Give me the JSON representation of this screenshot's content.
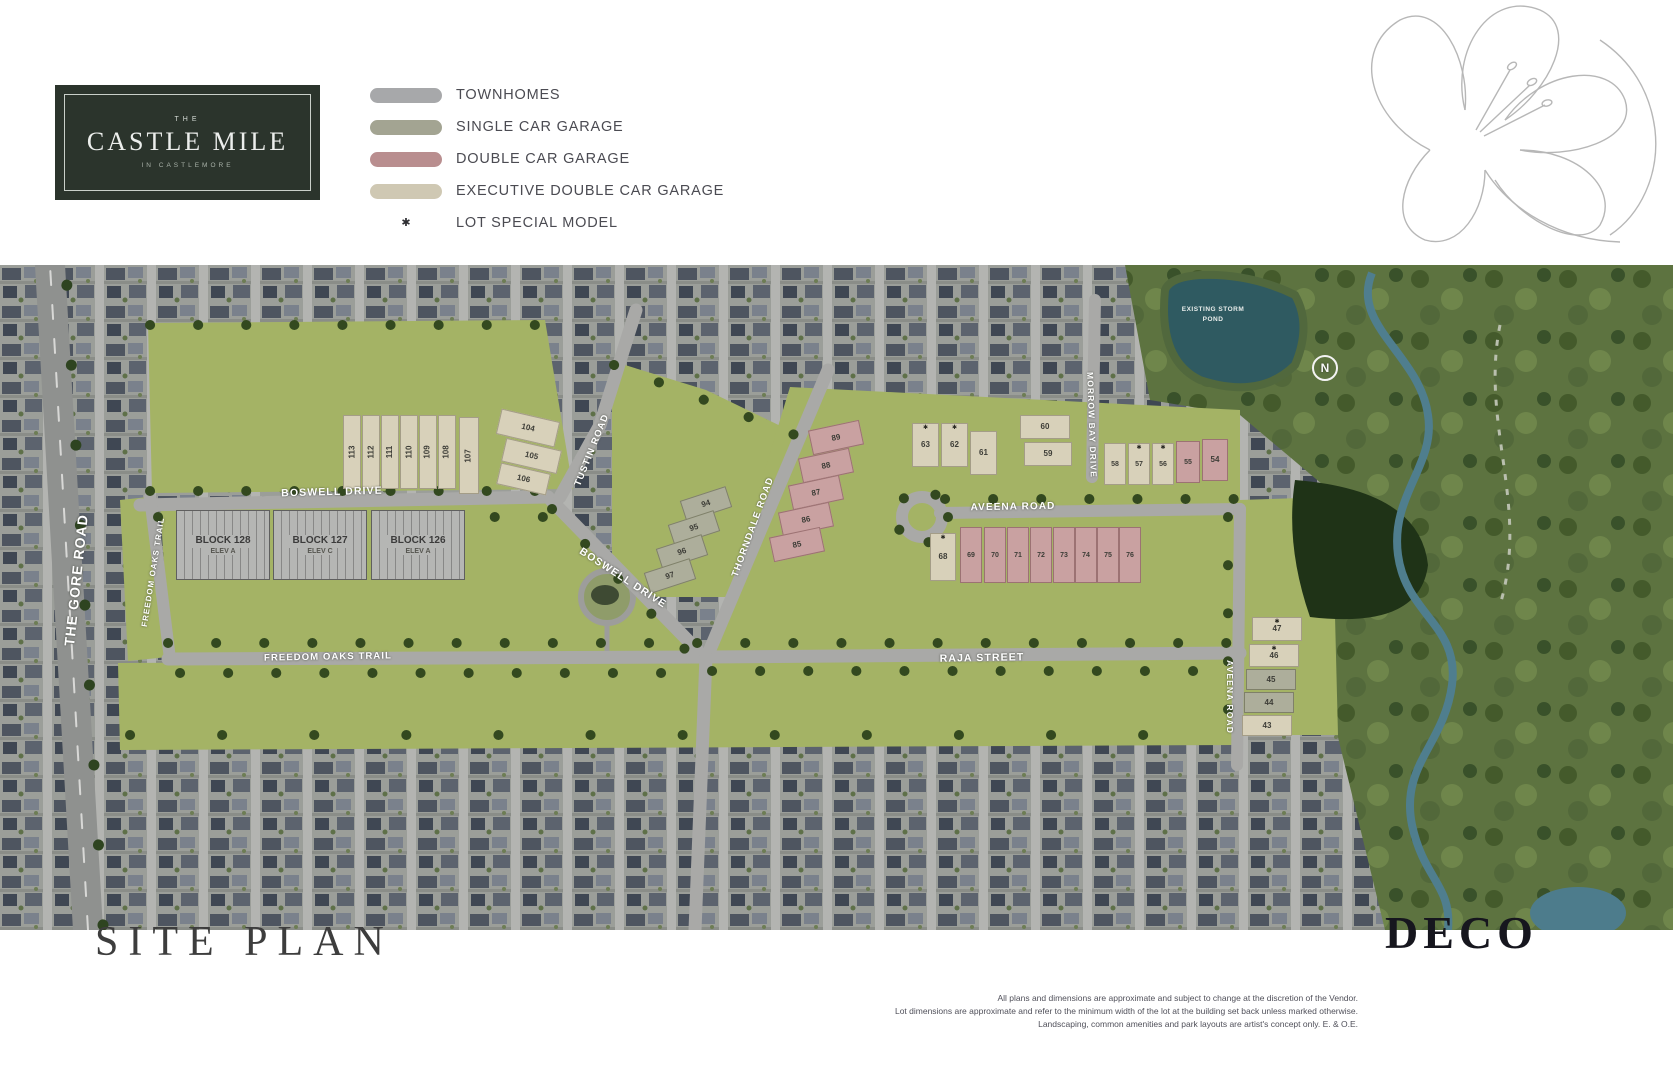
{
  "header": {
    "logo": {
      "top": "THE",
      "main": "CASTLE MILE",
      "sub": "IN CASTLEMORE"
    },
    "legend": [
      {
        "label": "TOWNHOMES",
        "type": "swatch",
        "color": "#a7a8aa"
      },
      {
        "label": "SINGLE CAR GARAGE",
        "type": "swatch",
        "color": "#a3a492"
      },
      {
        "label": "DOUBLE CAR GARAGE",
        "type": "swatch",
        "color": "#b98e8f"
      },
      {
        "label": "EXECUTIVE DOUBLE CAR GARAGE",
        "type": "swatch",
        "color": "#cfc8b3"
      },
      {
        "label": "LOT SPECIAL MODEL",
        "type": "star",
        "icon": "✱"
      }
    ]
  },
  "map": {
    "compass_label": "N",
    "pond_label": "EXISTING STORM POND",
    "road_labels": [
      {
        "text": "THE GORE ROAD",
        "x": 76,
        "y": 315,
        "rot": -84,
        "size": 14
      },
      {
        "text": "FREEDOM OAKS TRAIL",
        "x": 153,
        "y": 307,
        "rot": -81,
        "size": 8
      },
      {
        "text": "BOSWELL DRIVE",
        "x": 332,
        "y": 227,
        "rot": -1.5,
        "size": 10.5
      },
      {
        "text": "TUSTIN ROAD",
        "x": 592,
        "y": 185,
        "rot": -68,
        "size": 9.5
      },
      {
        "text": "BOSWELL DRIVE",
        "x": 623,
        "y": 313,
        "rot": 33,
        "size": 10.5
      },
      {
        "text": "THORNDALE ROAD",
        "x": 753,
        "y": 262,
        "rot": -70,
        "size": 9.5
      },
      {
        "text": "FREEDOM OAKS TRAIL",
        "x": 328,
        "y": 392,
        "rot": -1,
        "size": 9.5
      },
      {
        "text": "AVEENA ROAD",
        "x": 1013,
        "y": 242,
        "rot": -1,
        "size": 10
      },
      {
        "text": "RAJA STREET",
        "x": 982,
        "y": 393,
        "rot": -1,
        "size": 10.5
      },
      {
        "text": "MORROW BAY DRIVE",
        "x": 1092,
        "y": 160,
        "rot": 88,
        "size": 8.5
      },
      {
        "text": "AVEENA ROAD",
        "x": 1230,
        "y": 432,
        "rot": 90,
        "size": 8.5
      }
    ],
    "blocks": [
      {
        "name": "BLOCK 128",
        "elev": "ELEV A",
        "x": 176,
        "y": 245
      },
      {
        "name": "BLOCK 127",
        "elev": "ELEV C",
        "x": 273,
        "y": 245
      },
      {
        "name": "BLOCK 126",
        "elev": "ELEV A",
        "x": 371,
        "y": 245
      }
    ],
    "lots": [
      {
        "n": "113",
        "t": "exec",
        "x": 343,
        "y": 150,
        "w": 18,
        "h": 74,
        "nr": -90
      },
      {
        "n": "112",
        "t": "exec",
        "x": 362,
        "y": 150,
        "w": 18,
        "h": 74,
        "nr": -90
      },
      {
        "n": "111",
        "t": "exec",
        "x": 381,
        "y": 150,
        "w": 18,
        "h": 74,
        "nr": -90
      },
      {
        "n": "110",
        "t": "exec",
        "x": 400,
        "y": 150,
        "w": 18,
        "h": 74,
        "nr": -90
      },
      {
        "n": "109",
        "t": "exec",
        "x": 419,
        "y": 150,
        "w": 18,
        "h": 74,
        "nr": -90
      },
      {
        "n": "108",
        "t": "exec",
        "x": 438,
        "y": 150,
        "w": 18,
        "h": 74,
        "nr": -90
      },
      {
        "n": "107",
        "t": "exec",
        "x": 459,
        "y": 152,
        "w": 20,
        "h": 77,
        "nr": -90
      },
      {
        "n": "104",
        "t": "exec",
        "x": 498,
        "y": 150,
        "w": 60,
        "h": 26,
        "r": 13
      },
      {
        "n": "105",
        "t": "exec",
        "x": 503,
        "y": 179,
        "w": 57,
        "h": 24,
        "r": 13
      },
      {
        "n": "106",
        "t": "exec",
        "x": 498,
        "y": 203,
        "w": 51,
        "h": 22,
        "r": 13
      },
      {
        "n": "94",
        "t": "single",
        "x": 682,
        "y": 228,
        "w": 48,
        "h": 22,
        "r": -18
      },
      {
        "n": "95",
        "t": "single",
        "x": 670,
        "y": 252,
        "w": 48,
        "h": 22,
        "r": -18
      },
      {
        "n": "96",
        "t": "single",
        "x": 658,
        "y": 276,
        "w": 48,
        "h": 22,
        "r": -18
      },
      {
        "n": "97",
        "t": "single",
        "x": 646,
        "y": 300,
        "w": 48,
        "h": 22,
        "r": -18
      },
      {
        "n": "89",
        "t": "double",
        "x": 810,
        "y": 160,
        "w": 52,
        "h": 25,
        "r": -12
      },
      {
        "n": "88",
        "t": "double",
        "x": 800,
        "y": 188,
        "w": 52,
        "h": 25,
        "r": -12
      },
      {
        "n": "87",
        "t": "double",
        "x": 790,
        "y": 215,
        "w": 52,
        "h": 25,
        "r": -12
      },
      {
        "n": "86",
        "t": "double",
        "x": 780,
        "y": 242,
        "w": 52,
        "h": 25,
        "r": -12
      },
      {
        "n": "85",
        "t": "double",
        "x": 771,
        "y": 267,
        "w": 52,
        "h": 25,
        "r": -12
      },
      {
        "n": "63",
        "t": "exec",
        "x": 912,
        "y": 158,
        "w": 27,
        "h": 44,
        "star": true
      },
      {
        "n": "62",
        "t": "exec",
        "x": 941,
        "y": 158,
        "w": 27,
        "h": 44,
        "star": true
      },
      {
        "n": "61",
        "t": "exec",
        "x": 970,
        "y": 166,
        "w": 27,
        "h": 44
      },
      {
        "n": "60",
        "t": "exec",
        "x": 1020,
        "y": 150,
        "w": 50,
        "h": 24
      },
      {
        "n": "59",
        "t": "exec",
        "x": 1024,
        "y": 177,
        "w": 48,
        "h": 24
      },
      {
        "n": "58",
        "t": "exec",
        "x": 1104,
        "y": 178,
        "w": 22,
        "h": 42
      },
      {
        "n": "57",
        "t": "exec",
        "x": 1128,
        "y": 178,
        "w": 22,
        "h": 42,
        "star": true
      },
      {
        "n": "56",
        "t": "exec",
        "x": 1152,
        "y": 178,
        "w": 22,
        "h": 42,
        "star": true
      },
      {
        "n": "55",
        "t": "double",
        "x": 1176,
        "y": 176,
        "w": 24,
        "h": 42
      },
      {
        "n": "54",
        "t": "double",
        "x": 1202,
        "y": 174,
        "w": 26,
        "h": 42
      },
      {
        "n": "68",
        "t": "exec",
        "x": 930,
        "y": 268,
        "w": 26,
        "h": 48,
        "star": true
      },
      {
        "n": "69",
        "t": "double",
        "x": 960,
        "y": 262,
        "w": 22,
        "h": 56
      },
      {
        "n": "70",
        "t": "double",
        "x": 984,
        "y": 262,
        "w": 22,
        "h": 56
      },
      {
        "n": "71",
        "t": "double",
        "x": 1007,
        "y": 262,
        "w": 22,
        "h": 56
      },
      {
        "n": "72",
        "t": "double",
        "x": 1030,
        "y": 262,
        "w": 22,
        "h": 56
      },
      {
        "n": "73",
        "t": "double",
        "x": 1053,
        "y": 262,
        "w": 22,
        "h": 56
      },
      {
        "n": "74",
        "t": "double",
        "x": 1075,
        "y": 262,
        "w": 22,
        "h": 56
      },
      {
        "n": "75",
        "t": "double",
        "x": 1097,
        "y": 262,
        "w": 22,
        "h": 56
      },
      {
        "n": "76",
        "t": "double",
        "x": 1119,
        "y": 262,
        "w": 22,
        "h": 56
      },
      {
        "n": "47",
        "t": "exec",
        "x": 1252,
        "y": 352,
        "w": 50,
        "h": 24,
        "star": true
      },
      {
        "n": "46",
        "t": "exec",
        "x": 1249,
        "y": 379,
        "w": 50,
        "h": 23,
        "star": true
      },
      {
        "n": "45",
        "t": "single",
        "x": 1246,
        "y": 404,
        "w": 50,
        "h": 21
      },
      {
        "n": "44",
        "t": "single",
        "x": 1244,
        "y": 427,
        "w": 50,
        "h": 21
      },
      {
        "n": "43",
        "t": "exec",
        "x": 1242,
        "y": 450,
        "w": 50,
        "h": 21
      }
    ]
  },
  "footer": {
    "title": "SITE PLAN",
    "brand": "DECO",
    "disclaimer_lines": [
      "All plans and dimensions are approximate and subject to change at the discretion of the Vendor.",
      "Lot dimensions are approximate and refer to the minimum width of the lot at the building set back unless marked otherwise.",
      "Landscaping, common amenities and park layouts are artist's concept only. E. & O.E."
    ]
  },
  "colors": {
    "logo_bg": "#2b342c",
    "dev_green": "#a4b365",
    "road_gray": "#a9a9a7",
    "pond": "#2f5a61",
    "creek": "#4f7e8e",
    "tree": "#33491f"
  }
}
